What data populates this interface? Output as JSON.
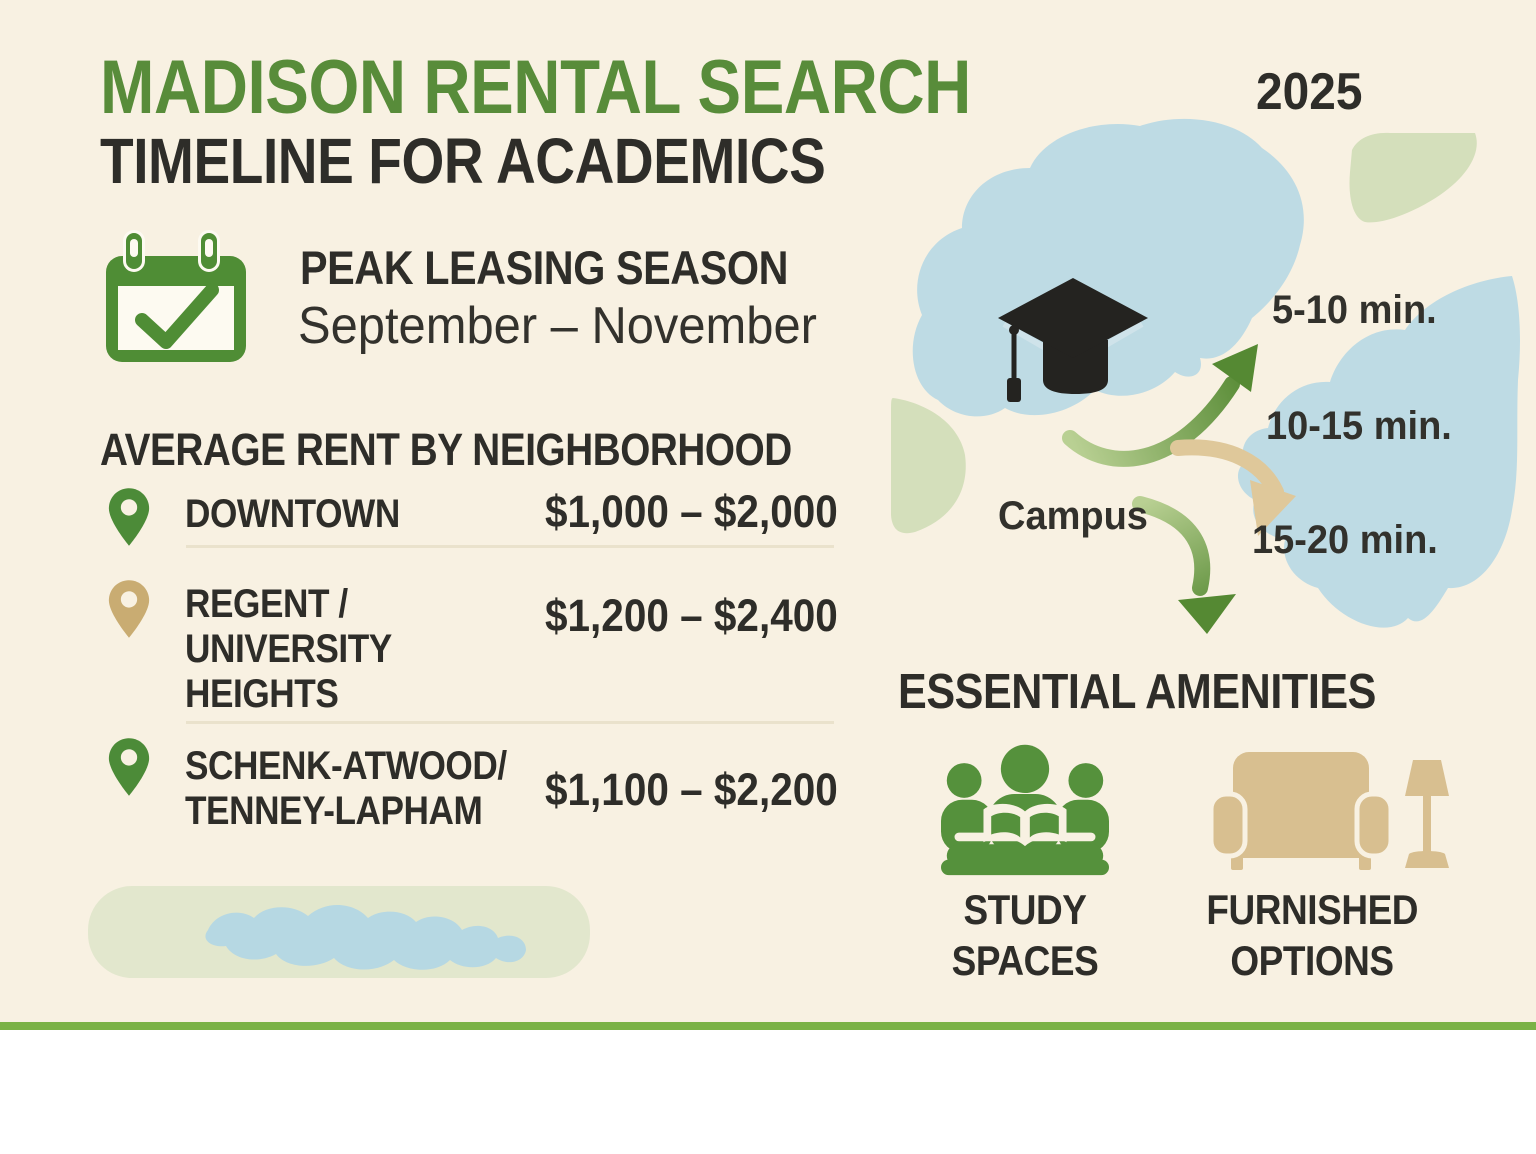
{
  "title": {
    "line1": "MADISON RENTAL SEARCH",
    "line2": "TIMELINE FOR ACADEMICS",
    "year": "2025"
  },
  "peak_season": {
    "heading": "PEAK LEASING SEASON",
    "range": "September – November",
    "icon": "calendar-check-icon"
  },
  "rent": {
    "heading": "AVERAGE RENT BY NEIGHBORHOOD",
    "rows": [
      {
        "name": "DOWNTOWN",
        "price": "$1,000 – $2,000",
        "pin": "green-map-pin"
      },
      {
        "name": "REGENT /\nUNIVERSITY\nHEIGHTS",
        "price": "$1,200 – $2,400",
        "pin": "tan-map-pin"
      },
      {
        "name": "SCHENK-ATWOOD/\nTENNEY-LAPHAM",
        "price": "$1,100 – $2,200",
        "pin": "green-map-pin"
      }
    ]
  },
  "map": {
    "campus_label": "Campus",
    "travel_times": [
      {
        "label": "5-10 min."
      },
      {
        "label": "10-15 min."
      },
      {
        "label": "15-20 min."
      }
    ],
    "icons": [
      "graduation-cap-icon",
      "lake-shape",
      "lake-shape",
      "curved-arrow"
    ]
  },
  "amenities": {
    "heading": "ESSENTIAL AMENITIES",
    "items": [
      {
        "label": "STUDY\nSPACES",
        "icon": "study-spaces-icon"
      },
      {
        "label": "FURNISHED\nOPTIONS",
        "icon": "furnished-options-icon"
      }
    ]
  },
  "colors": {
    "cream": "#f8f1e2",
    "dark": "#2e2d29",
    "green": "#588c3a",
    "cal_green": "#4f8d35",
    "study_green": "#55913c",
    "pin_green": "#4c8b38",
    "pin_tan": "#c9ac72",
    "couch_tan": "#d8bf90",
    "arrow_tan": "#dfc89a",
    "lake": "#bedbe4",
    "pale_green": "#d4dfbb",
    "pill_green": "#e2e7cd",
    "squiggle_blue": "#b6d8e3",
    "divider": "#eae2cc",
    "footer_green": "#7ab246",
    "arrow_green_light": "#b9d093",
    "arrow_green_dark": "#558933",
    "cap_black": "#242320"
  }
}
